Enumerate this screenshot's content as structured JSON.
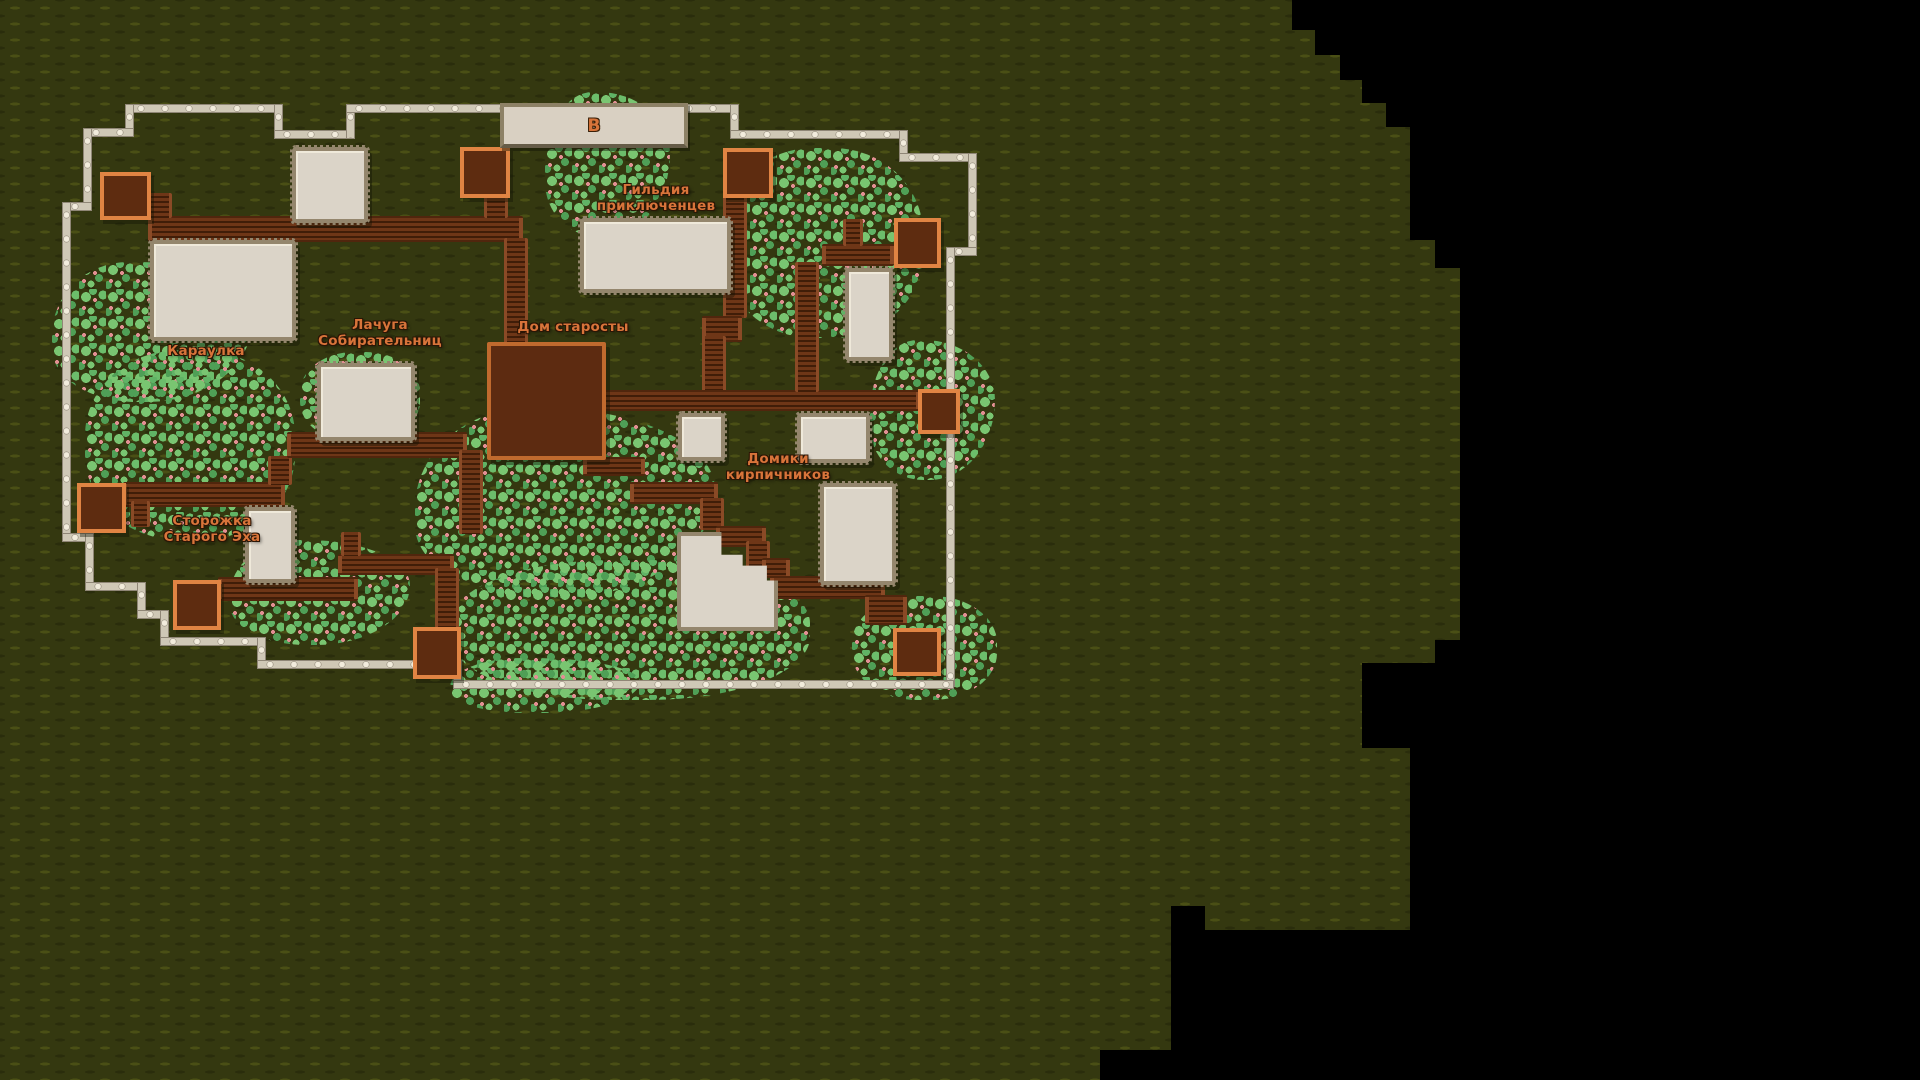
{
  "map": {
    "sign": {
      "letter": "В",
      "x": 500,
      "y": 103,
      "w": 180,
      "h": 37
    },
    "labels": [
      {
        "id": "adventurers-guild",
        "text": "Гильдия\nприключенцев",
        "x": 656,
        "y": 183
      },
      {
        "id": "elder-house",
        "text": "Дом старосты",
        "x": 573,
        "y": 320
      },
      {
        "id": "gatherers-shack",
        "text": "Лачуга\nСобирательниц",
        "x": 380,
        "y": 318
      },
      {
        "id": "guardhouse",
        "text": "Караулка",
        "x": 206,
        "y": 344
      },
      {
        "id": "old-echo-lodge",
        "text": "Сторожка\nСтарого Эха",
        "x": 212,
        "y": 514
      },
      {
        "id": "brickmakers-houses",
        "text": "Домики\nкирпичников",
        "x": 778,
        "y": 452
      }
    ],
    "colors": {
      "terrain": "#343810",
      "terrain_dash_light": "#4a4f15",
      "terrain_dash_dark": "#2a2d0c",
      "fog": "#000000",
      "building_fill": "#dbd4c8",
      "building_border": "#94866d",
      "dark_building_fill": "#5d2b11",
      "dark_building_border": "#c06a2e",
      "gate_border": "#e08443",
      "road_light": "#6e3617",
      "road_dark": "#401d08",
      "fence_rail": "#cfc8b6",
      "fence_post": "#f2ecdc",
      "bush_light": "#79c571",
      "bush_dark": "#4f9f56",
      "bush_berry": "#e28f93",
      "label_text": "#d8743a"
    },
    "fog_polygon": "polygon(1292px 0px,1920px 0px,1920px 1080px,1100px 1080px,1100px 1050px,1171px 1050px,1171px 906px,1205px 906px,1205px 930px,1410px 930px,1410px 748px,1362px 748px,1362px 663px,1435px 663px,1435px 640px,1460px 640px,1460px 268px,1435px 268px,1435px 240px,1410px 240px,1410px 127px,1386px 127px,1386px 103px,1362px 103px,1362px 80px,1340px 80px,1340px 55px,1315px 55px,1315px 30px,1292px 30px",
    "bushes": [
      {
        "x": 52,
        "y": 262,
        "w": 200,
        "h": 140
      },
      {
        "x": 85,
        "y": 350,
        "w": 210,
        "h": 190
      },
      {
        "x": 230,
        "y": 540,
        "w": 180,
        "h": 105
      },
      {
        "x": 300,
        "y": 352,
        "w": 120,
        "h": 90
      },
      {
        "x": 415,
        "y": 408,
        "w": 300,
        "h": 190
      },
      {
        "x": 450,
        "y": 560,
        "w": 360,
        "h": 140
      },
      {
        "x": 545,
        "y": 92,
        "w": 125,
        "h": 145
      },
      {
        "x": 723,
        "y": 148,
        "w": 200,
        "h": 190
      },
      {
        "x": 870,
        "y": 340,
        "w": 125,
        "h": 140
      },
      {
        "x": 852,
        "y": 596,
        "w": 145,
        "h": 104
      },
      {
        "x": 450,
        "y": 658,
        "w": 190,
        "h": 55
      }
    ],
    "fences": [
      {
        "x": 128,
        "y": 104,
        "w": 152,
        "h": 7
      },
      {
        "x": 274,
        "y": 104,
        "w": 7,
        "h": 33
      },
      {
        "x": 274,
        "y": 130,
        "w": 79,
        "h": 7
      },
      {
        "x": 346,
        "y": 104,
        "w": 7,
        "h": 33
      },
      {
        "x": 346,
        "y": 104,
        "w": 158,
        "h": 7
      },
      {
        "x": 676,
        "y": 104,
        "w": 60,
        "h": 7
      },
      {
        "x": 730,
        "y": 104,
        "w": 7,
        "h": 33
      },
      {
        "x": 730,
        "y": 130,
        "w": 176,
        "h": 7
      },
      {
        "x": 899,
        "y": 130,
        "w": 7,
        "h": 30
      },
      {
        "x": 899,
        "y": 153,
        "w": 76,
        "h": 7
      },
      {
        "x": 968,
        "y": 153,
        "w": 7,
        "h": 101
      },
      {
        "x": 946,
        "y": 247,
        "w": 29,
        "h": 7
      },
      {
        "x": 946,
        "y": 247,
        "w": 7,
        "h": 145
      },
      {
        "x": 946,
        "y": 423,
        "w": 7,
        "h": 262
      },
      {
        "x": 125,
        "y": 104,
        "w": 7,
        "h": 31
      },
      {
        "x": 83,
        "y": 128,
        "w": 49,
        "h": 7
      },
      {
        "x": 83,
        "y": 128,
        "w": 7,
        "h": 81
      },
      {
        "x": 62,
        "y": 202,
        "w": 28,
        "h": 7
      },
      {
        "x": 62,
        "y": 202,
        "w": 7,
        "h": 338
      },
      {
        "x": 62,
        "y": 533,
        "w": 30,
        "h": 7
      },
      {
        "x": 85,
        "y": 533,
        "w": 7,
        "h": 56
      },
      {
        "x": 85,
        "y": 582,
        "w": 59,
        "h": 7
      },
      {
        "x": 137,
        "y": 582,
        "w": 7,
        "h": 35
      },
      {
        "x": 137,
        "y": 610,
        "w": 30,
        "h": 7
      },
      {
        "x": 160,
        "y": 610,
        "w": 7,
        "h": 34
      },
      {
        "x": 160,
        "y": 637,
        "w": 104,
        "h": 7
      },
      {
        "x": 257,
        "y": 637,
        "w": 7,
        "h": 30
      },
      {
        "x": 257,
        "y": 660,
        "w": 160,
        "h": 7
      },
      {
        "x": 453,
        "y": 660,
        "w": 7,
        "h": 27
      },
      {
        "x": 453,
        "y": 680,
        "w": 499,
        "h": 7
      }
    ],
    "roads": [
      {
        "x": 148,
        "y": 216,
        "w": 375,
        "h": 22,
        "o": "h"
      },
      {
        "x": 148,
        "y": 193,
        "w": 18,
        "h": 25,
        "o": "v"
      },
      {
        "x": 484,
        "y": 188,
        "w": 18,
        "h": 30,
        "o": "v"
      },
      {
        "x": 504,
        "y": 238,
        "w": 18,
        "h": 106,
        "o": "v"
      },
      {
        "x": 723,
        "y": 190,
        "w": 18,
        "h": 128,
        "o": "v"
      },
      {
        "x": 702,
        "y": 316,
        "w": 40,
        "h": 22,
        "o": "h"
      },
      {
        "x": 702,
        "y": 336,
        "w": 18,
        "h": 56,
        "o": "v"
      },
      {
        "x": 598,
        "y": 390,
        "w": 322,
        "h": 17,
        "o": "h"
      },
      {
        "x": 822,
        "y": 244,
        "w": 72,
        "h": 18,
        "o": "h"
      },
      {
        "x": 843,
        "y": 219,
        "w": 14,
        "h": 27,
        "o": "v"
      },
      {
        "x": 795,
        "y": 262,
        "w": 18,
        "h": 130,
        "o": "v"
      },
      {
        "x": 583,
        "y": 457,
        "w": 62,
        "h": 15,
        "o": "h"
      },
      {
        "x": 630,
        "y": 482,
        "w": 88,
        "h": 18,
        "o": "h"
      },
      {
        "x": 700,
        "y": 498,
        "w": 18,
        "h": 32,
        "o": "v"
      },
      {
        "x": 716,
        "y": 526,
        "w": 50,
        "h": 17,
        "o": "h"
      },
      {
        "x": 746,
        "y": 541,
        "w": 18,
        "h": 30,
        "o": "v"
      },
      {
        "x": 762,
        "y": 558,
        "w": 28,
        "h": 16,
        "o": "h"
      },
      {
        "x": 770,
        "y": 576,
        "w": 115,
        "h": 19,
        "o": "h"
      },
      {
        "x": 865,
        "y": 595,
        "w": 42,
        "h": 26,
        "o": "h"
      },
      {
        "x": 123,
        "y": 482,
        "w": 162,
        "h": 21,
        "o": "h"
      },
      {
        "x": 131,
        "y": 501,
        "w": 13,
        "h": 26,
        "o": "v"
      },
      {
        "x": 268,
        "y": 456,
        "w": 18,
        "h": 29,
        "o": "v"
      },
      {
        "x": 287,
        "y": 432,
        "w": 180,
        "h": 22,
        "o": "h"
      },
      {
        "x": 459,
        "y": 450,
        "w": 18,
        "h": 84,
        "o": "v"
      },
      {
        "x": 338,
        "y": 554,
        "w": 116,
        "h": 17,
        "o": "h"
      },
      {
        "x": 341,
        "y": 532,
        "w": 14,
        "h": 24,
        "o": "v"
      },
      {
        "x": 435,
        "y": 568,
        "w": 18,
        "h": 60,
        "o": "v"
      },
      {
        "x": 218,
        "y": 577,
        "w": 140,
        "h": 20,
        "o": "h"
      }
    ],
    "buildings": [
      {
        "name": "small-house-northwest",
        "x": 292,
        "y": 147,
        "w": 68,
        "h": 68
      },
      {
        "name": "guardhouse",
        "x": 150,
        "y": 240,
        "w": 138,
        "h": 93
      },
      {
        "name": "gatherers-shack",
        "x": 317,
        "y": 363,
        "w": 90,
        "h": 70
      },
      {
        "name": "adventurers-guild",
        "x": 580,
        "y": 218,
        "w": 143,
        "h": 67
      },
      {
        "name": "tall-house-east",
        "x": 845,
        "y": 268,
        "w": 40,
        "h": 85
      },
      {
        "name": "shed-center-1",
        "x": 678,
        "y": 413,
        "w": 39,
        "h": 40
      },
      {
        "name": "shed-center-2",
        "x": 797,
        "y": 413,
        "w": 65,
        "h": 42
      },
      {
        "name": "brickmaker-house-east",
        "x": 820,
        "y": 483,
        "w": 68,
        "h": 94
      },
      {
        "name": "brickmaker-house-l",
        "x": 677,
        "y": 532,
        "w": 93,
        "h": 91,
        "clip": "polygon(0 0,44% 0,44% 23%,65% 23%,65% 34%,89% 34%,89% 49%,100% 49%,100% 100%,0 100%)"
      },
      {
        "name": "old-echo-lodge",
        "x": 245,
        "y": 507,
        "w": 42,
        "h": 68
      }
    ],
    "dark_buildings": [
      {
        "name": "elder-house",
        "x": 487,
        "y": 342,
        "w": 111,
        "h": 110
      }
    ],
    "gates": [
      {
        "name": "gate-northwest",
        "x": 100,
        "y": 172,
        "w": 43,
        "h": 40
      },
      {
        "name": "gate-north-center",
        "x": 460,
        "y": 147,
        "w": 42,
        "h": 43
      },
      {
        "name": "gate-north-east",
        "x": 723,
        "y": 148,
        "w": 42,
        "h": 42
      },
      {
        "name": "gate-east-upper",
        "x": 894,
        "y": 218,
        "w": 39,
        "h": 42
      },
      {
        "name": "gate-east-lower",
        "x": 918,
        "y": 389,
        "w": 34,
        "h": 37
      },
      {
        "name": "gate-west",
        "x": 77,
        "y": 483,
        "w": 41,
        "h": 42
      },
      {
        "name": "gate-southwest",
        "x": 173,
        "y": 580,
        "w": 40,
        "h": 42
      },
      {
        "name": "gate-south-center",
        "x": 413,
        "y": 627,
        "w": 40,
        "h": 44
      },
      {
        "name": "gate-southeast",
        "x": 893,
        "y": 628,
        "w": 40,
        "h": 40
      }
    ]
  }
}
